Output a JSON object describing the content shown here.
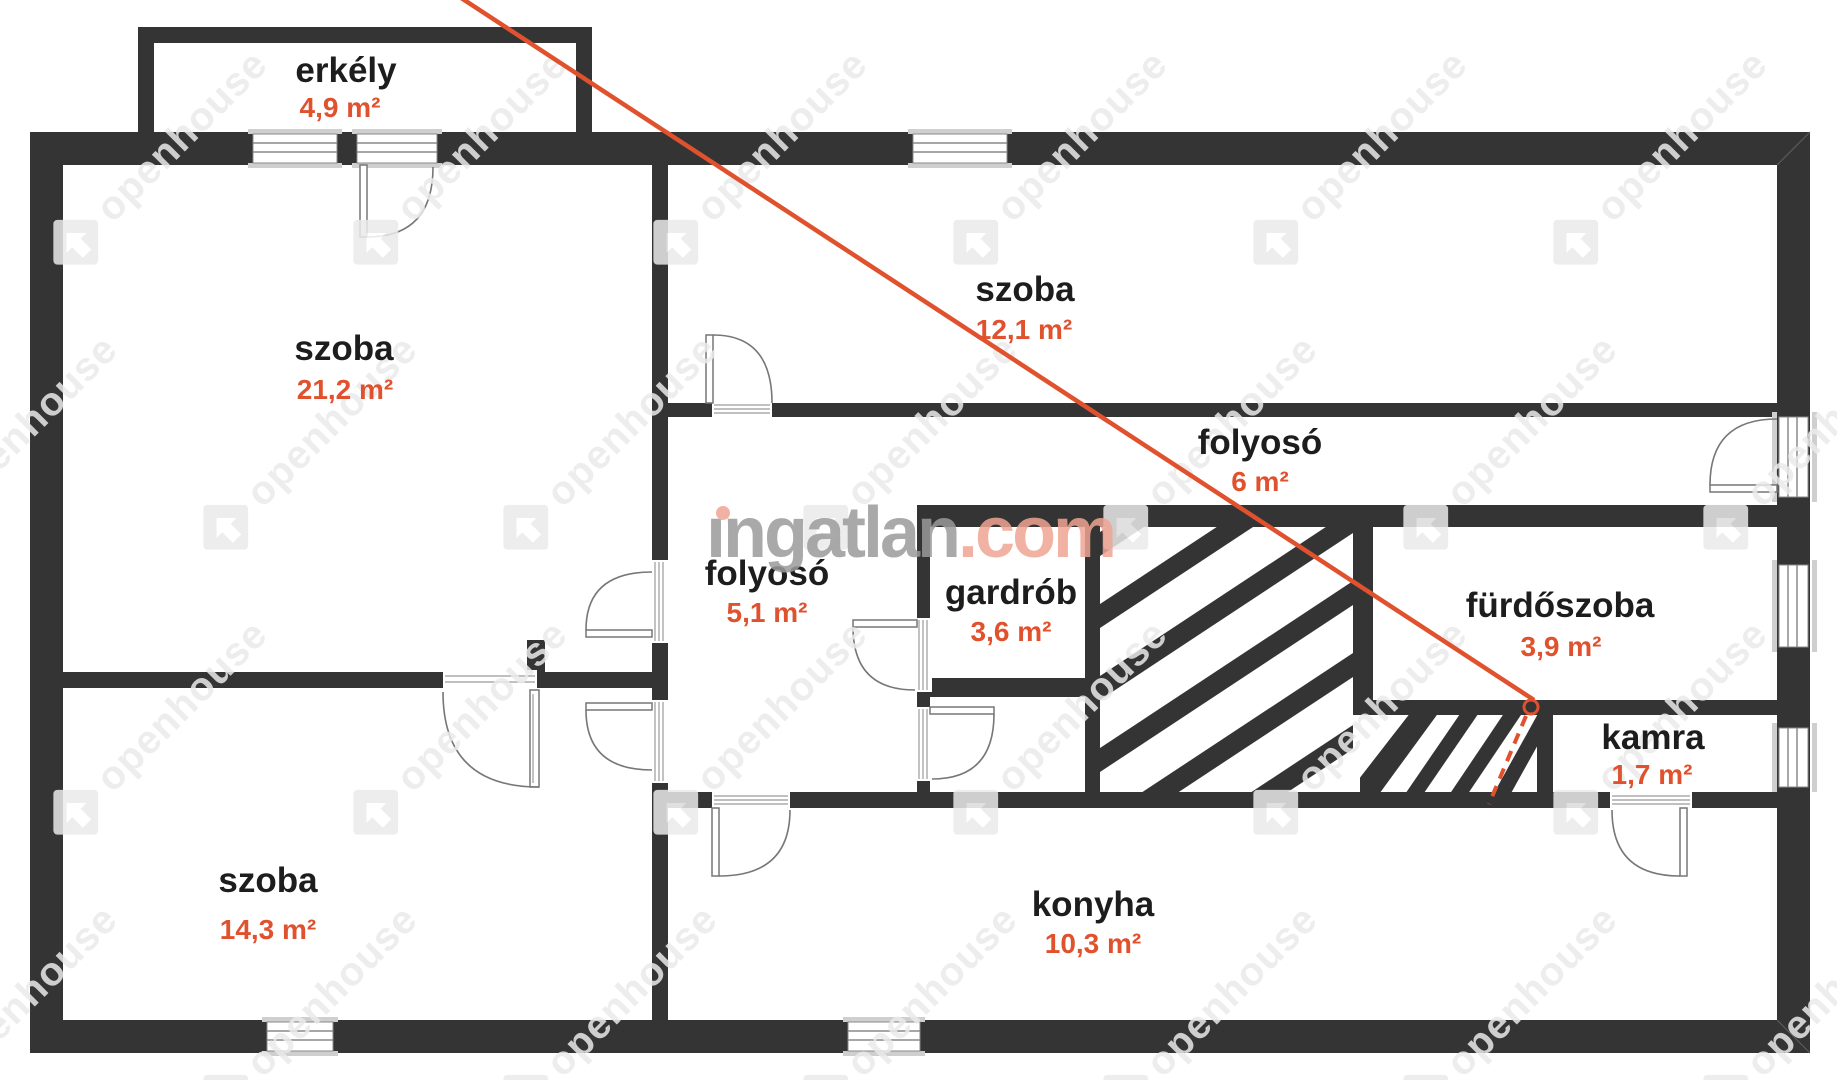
{
  "plan": {
    "type": "floor-plan",
    "units": "m²",
    "watermark_note": "real-estate portal watermark over architectural floor plan"
  },
  "brand": {
    "gray": "ıngatlan",
    "accent": ".com",
    "tile": "openhouse"
  },
  "colors": {
    "wall": "#343434",
    "accent_orange": "#e0512d",
    "room_name_text": "#1d1d1d",
    "watermark_gray": "#9b9b9b",
    "watermark_salmon": "#f0a593",
    "tile_gray": "#eaeaea",
    "window_frame": "#cfcfcf"
  },
  "rooms": [
    {
      "id": "erkely",
      "name": "erkély",
      "area": "4,9 m²"
    },
    {
      "id": "szoba-21",
      "name": "szoba",
      "area": "21,2 m²"
    },
    {
      "id": "szoba-12",
      "name": "szoba",
      "area": "12,1 m²"
    },
    {
      "id": "folyoso-6",
      "name": "folyosó",
      "area": "6 m²"
    },
    {
      "id": "folyoso-51",
      "name": "folyosó",
      "area": "5,1 m²"
    },
    {
      "id": "gardrob",
      "name": "gardrób",
      "area": "3,6 m²"
    },
    {
      "id": "furdoszoba",
      "name": "fürdőszoba",
      "area": "3,9 m²"
    },
    {
      "id": "kamra",
      "name": "kamra",
      "area": "1,7 m²"
    },
    {
      "id": "szoba-14",
      "name": "szoba",
      "area": "14,3 m²"
    },
    {
      "id": "konyha",
      "name": "konyha",
      "area": "10,3 m²"
    }
  ]
}
